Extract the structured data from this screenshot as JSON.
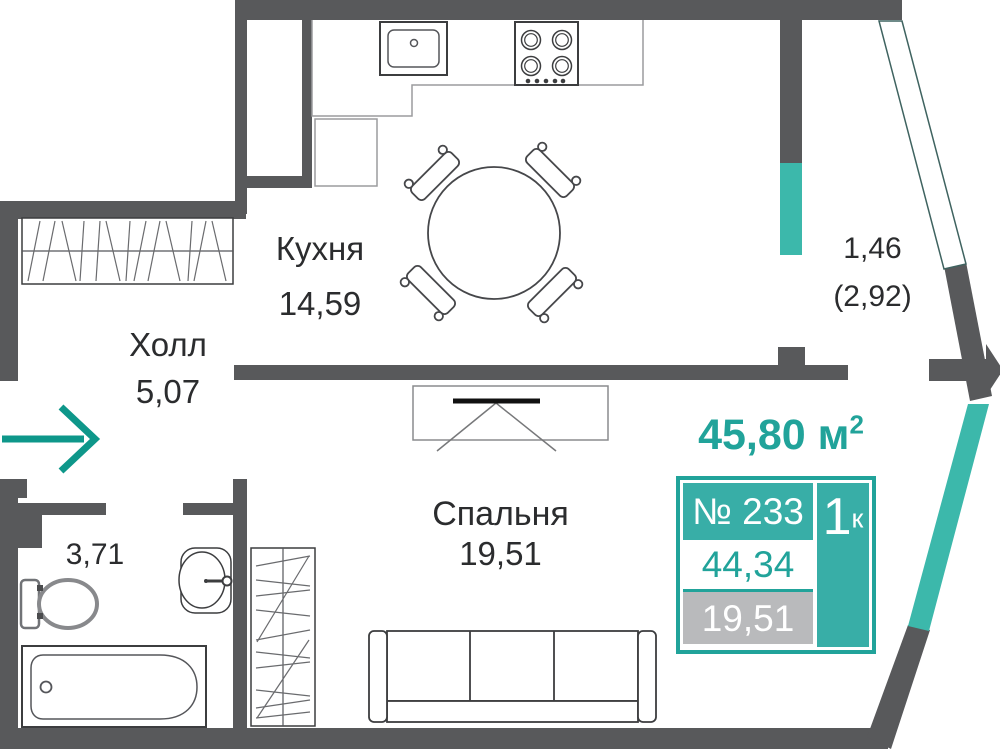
{
  "header": {
    "value": "45,80",
    "unit": " м",
    "sup": "2"
  },
  "rooms": {
    "kitchen": {
      "name": "Кухня",
      "area": "14,59"
    },
    "hall": {
      "name": "Холл",
      "area": "5,07"
    },
    "bathroom": {
      "area": "3,71"
    },
    "bedroom": {
      "name": "Спальня",
      "area": "19,51"
    },
    "balcony": {
      "area": "1,46",
      "area_alt": "(2,92)"
    }
  },
  "card": {
    "number": "№ 233",
    "rooms_count": "1",
    "rooms_sup": "к",
    "total_area": "44,34",
    "living_area": "19,51"
  },
  "colors": {
    "accent": "#21a39a",
    "accent_fill": "#38aea7",
    "wall_gray": "#58595b",
    "muted_gray": "#b9babc"
  }
}
